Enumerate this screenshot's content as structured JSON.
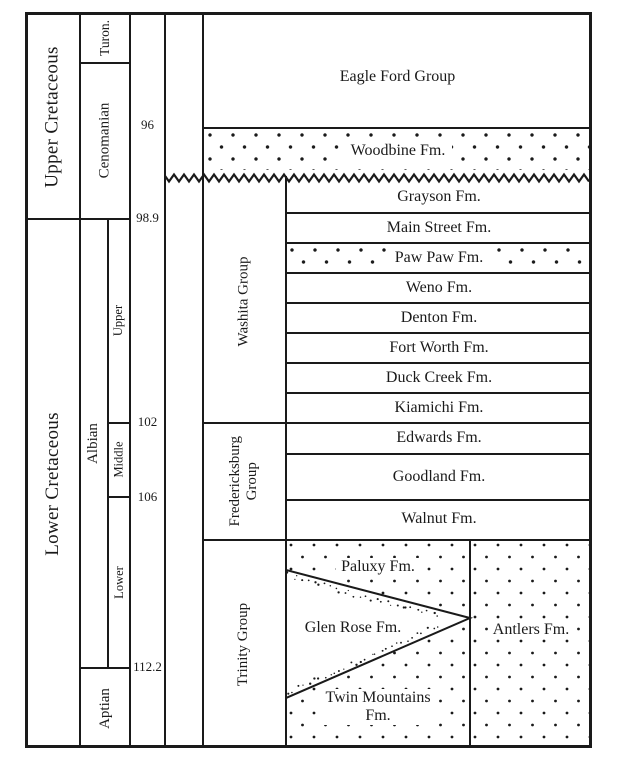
{
  "epochs": {
    "upper": "Upper Cretaceous",
    "lower": "Lower Cretaceous"
  },
  "stages": {
    "turonian": "Turon.",
    "cenomanian": "Cenomanian",
    "albian": "Albian",
    "aptian": "Aptian"
  },
  "albian_substages": {
    "upper": "Upper",
    "middle": "Middle",
    "lower": "Lower"
  },
  "ages_ma": {
    "v96": "96",
    "v98_9": "98.9",
    "v102": "102",
    "v106": "106",
    "v112_2": "112.2"
  },
  "groups": {
    "washita": "Washita Group",
    "fredericksburg": [
      "Fredericksburg",
      "Group"
    ],
    "trinity": "Trinity Group"
  },
  "formations": {
    "eagle_ford": "Eagle Ford Group",
    "woodbine": "Woodbine Fm.",
    "washita": [
      "Grayson Fm.",
      "Main Street Fm.",
      "Paw Paw Fm.",
      "Weno Fm.",
      "Denton Fm.",
      "Fort Worth Fm.",
      "Duck Creek Fm.",
      "Kiamichi Fm."
    ],
    "fredericksburg": [
      "Edwards Fm.",
      "Goodland Fm.",
      "Walnut Fm."
    ],
    "trinity": {
      "paluxy": "Paluxy Fm.",
      "glen_rose": "Glen Rose Fm.",
      "antlers": "Antlers Fm.",
      "twin_mountains": [
        "Twin Mountains",
        "Fm."
      ]
    }
  },
  "colors": {
    "ink": "#1a1a1a",
    "paper": "#ffffff"
  }
}
